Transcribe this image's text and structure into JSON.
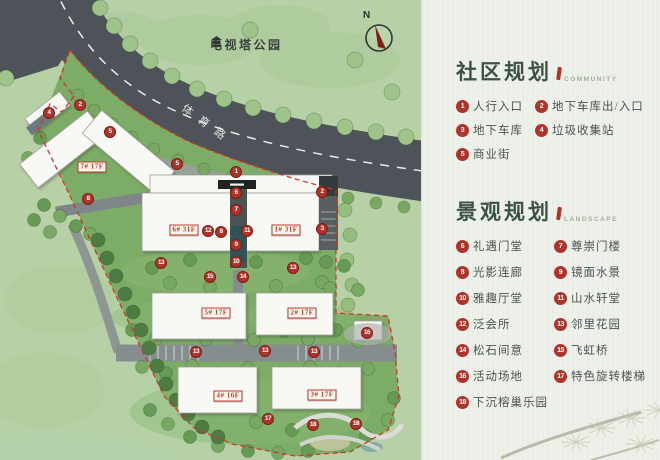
{
  "map": {
    "park_label": "电视塔公园",
    "road_label": "体育路",
    "compass_label": "N",
    "buildings": [
      {
        "label": "7# 17F",
        "x": 92,
        "y": 167
      },
      {
        "label": "6# 31F",
        "x": 184,
        "y": 230
      },
      {
        "label": "1# 31F",
        "x": 286,
        "y": 230
      },
      {
        "label": "5# 17F",
        "x": 216,
        "y": 313
      },
      {
        "label": "2# 17F",
        "x": 302,
        "y": 313
      },
      {
        "label": "4# 16F",
        "x": 228,
        "y": 396
      },
      {
        "label": "3# 17F",
        "x": 322,
        "y": 395
      }
    ],
    "markers": [
      {
        "n": 1,
        "x": 236,
        "y": 172
      },
      {
        "n": 2,
        "x": 80,
        "y": 105
      },
      {
        "n": 2,
        "x": 322,
        "y": 192
      },
      {
        "n": 3,
        "x": 322,
        "y": 229
      },
      {
        "n": 4,
        "x": 49,
        "y": 113
      },
      {
        "n": 5,
        "x": 110,
        "y": 132
      },
      {
        "n": 5,
        "x": 177,
        "y": 164
      },
      {
        "n": 6,
        "x": 236,
        "y": 193
      },
      {
        "n": 7,
        "x": 236,
        "y": 210
      },
      {
        "n": 8,
        "x": 88,
        "y": 199
      },
      {
        "n": 8,
        "x": 221,
        "y": 232
      },
      {
        "n": 9,
        "x": 236,
        "y": 245
      },
      {
        "n": 10,
        "x": 236,
        "y": 262
      },
      {
        "n": 11,
        "x": 247,
        "y": 231
      },
      {
        "n": 12,
        "x": 208,
        "y": 231
      },
      {
        "n": 13,
        "x": 161,
        "y": 263
      },
      {
        "n": 13,
        "x": 293,
        "y": 268
      },
      {
        "n": 13,
        "x": 196,
        "y": 352
      },
      {
        "n": 13,
        "x": 265,
        "y": 351
      },
      {
        "n": 13,
        "x": 314,
        "y": 352
      },
      {
        "n": 14,
        "x": 243,
        "y": 277
      },
      {
        "n": 15,
        "x": 210,
        "y": 277
      },
      {
        "n": 16,
        "x": 367,
        "y": 333
      },
      {
        "n": 17,
        "x": 268,
        "y": 419
      },
      {
        "n": 18,
        "x": 313,
        "y": 425
      },
      {
        "n": 18,
        "x": 356,
        "y": 424
      }
    ]
  },
  "legend": {
    "sections": [
      {
        "title": "社区规划",
        "subtitle": "COMMUNITY",
        "items": [
          {
            "n": 1,
            "label": "人行入口"
          },
          {
            "n": 2,
            "label": "地下车库出/入口"
          },
          {
            "n": 3,
            "label": "地下车库"
          },
          {
            "n": 4,
            "label": "垃圾收集站"
          },
          {
            "n": 5,
            "label": "商业街"
          }
        ]
      },
      {
        "title": "景观规划",
        "subtitle": "LANDSCAPE",
        "items": [
          {
            "n": 6,
            "label": "礼遇门堂"
          },
          {
            "n": 7,
            "label": "尊崇门楼"
          },
          {
            "n": 8,
            "label": "光影连廊"
          },
          {
            "n": 9,
            "label": "镜面水景"
          },
          {
            "n": 10,
            "label": "雅趣厅堂"
          },
          {
            "n": 11,
            "label": "山水轩堂"
          },
          {
            "n": 12,
            "label": "泛会所"
          },
          {
            "n": 13,
            "label": "邻里花园"
          },
          {
            "n": 14,
            "label": "松石间意"
          },
          {
            "n": 15,
            "label": "飞虹桥"
          },
          {
            "n": 16,
            "label": "活动场地"
          },
          {
            "n": 17,
            "label": "特色旋转楼梯"
          },
          {
            "n": 18,
            "label": "下沉榕巢乐园"
          }
        ]
      }
    ]
  },
  "colors": {
    "accent_red": "#b0332b",
    "chip_red": "#c0382e",
    "boundary_red": "#d42f22",
    "title_green": "#3d5247",
    "text_green": "#49564b",
    "panel_bg": "#edf1ea",
    "road_gray": "#4d5358",
    "site_green": "#7dac66",
    "park_green": "#b6d1a6"
  }
}
